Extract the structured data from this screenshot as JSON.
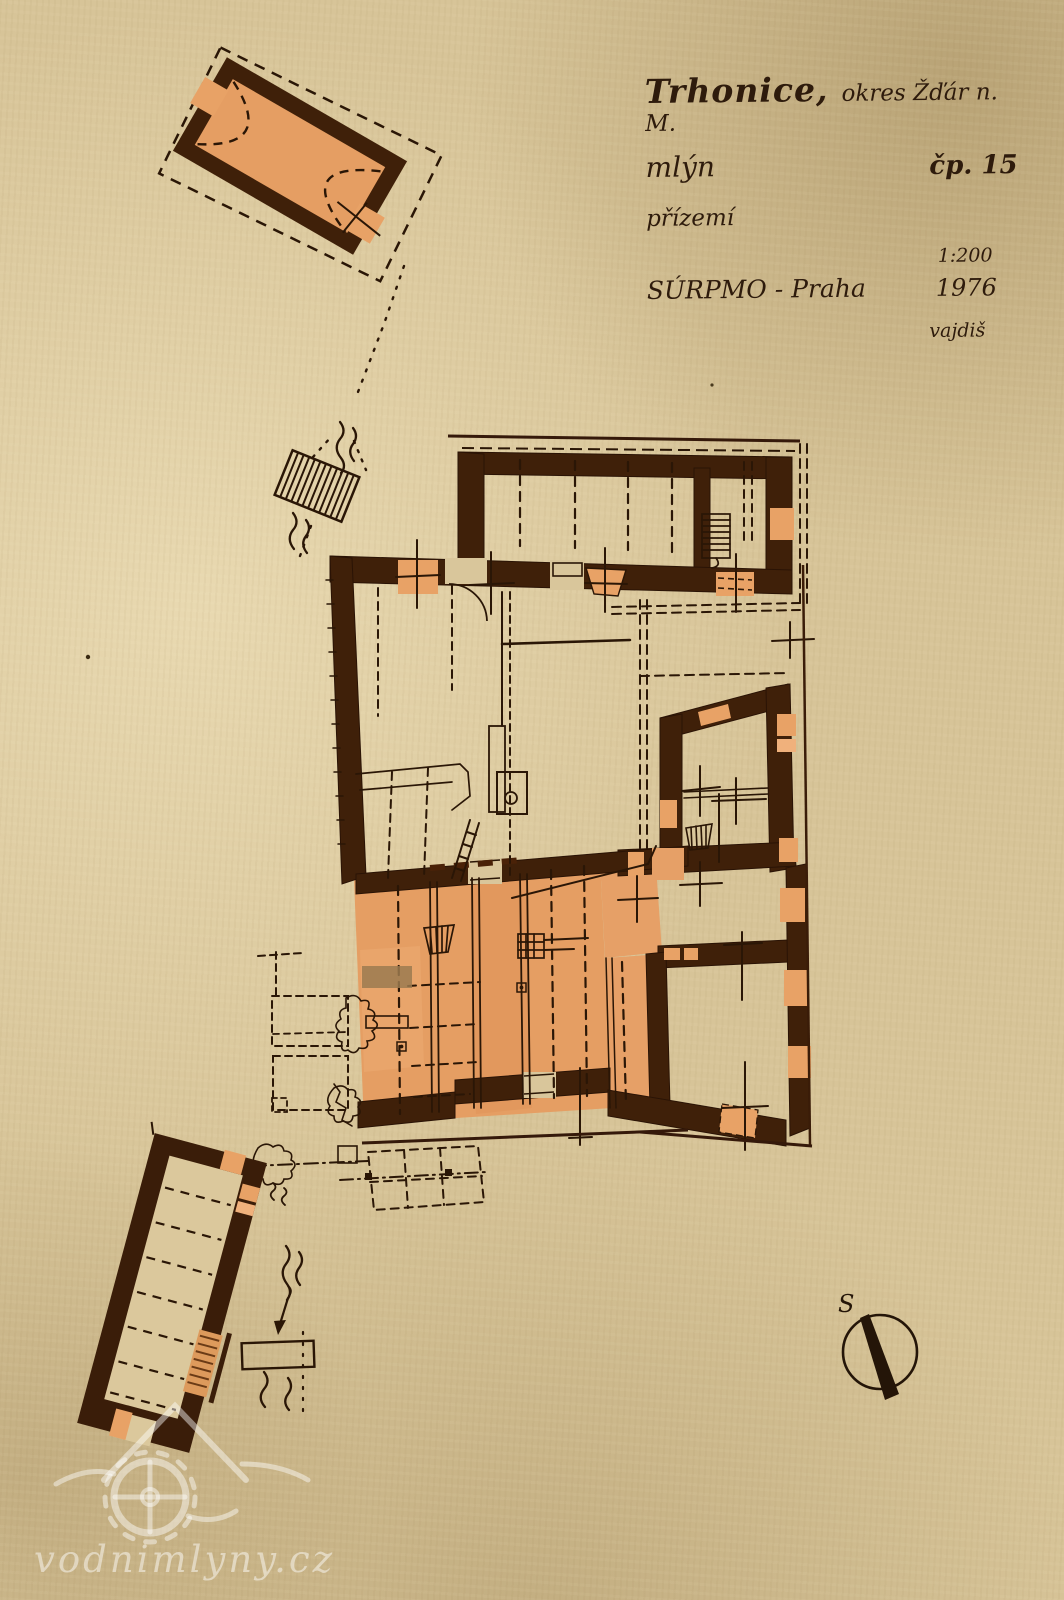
{
  "title_block": {
    "settlement": "Trhonice,",
    "district": "okres Žďár n. M.",
    "building_type": "mlýn",
    "house_number": "čp. 15",
    "floor": "přízemí",
    "scale": "1:200",
    "institution": "SÚRPMO - Praha",
    "year": "1976",
    "author": "vajdiš"
  },
  "compass": {
    "north_label": "S"
  },
  "watermark": {
    "text": "vodnimlyny.cz"
  },
  "legend": {
    "drawing_kind": "ground-floor plan of a water mill",
    "masonry_wall_color": "#3f2009",
    "heated_room_wash_color": "#e59e63",
    "ink_color": "#2a1606",
    "paper_color": "#d7c498",
    "watermark_color": "rgba(255,255,255,0.45)"
  }
}
